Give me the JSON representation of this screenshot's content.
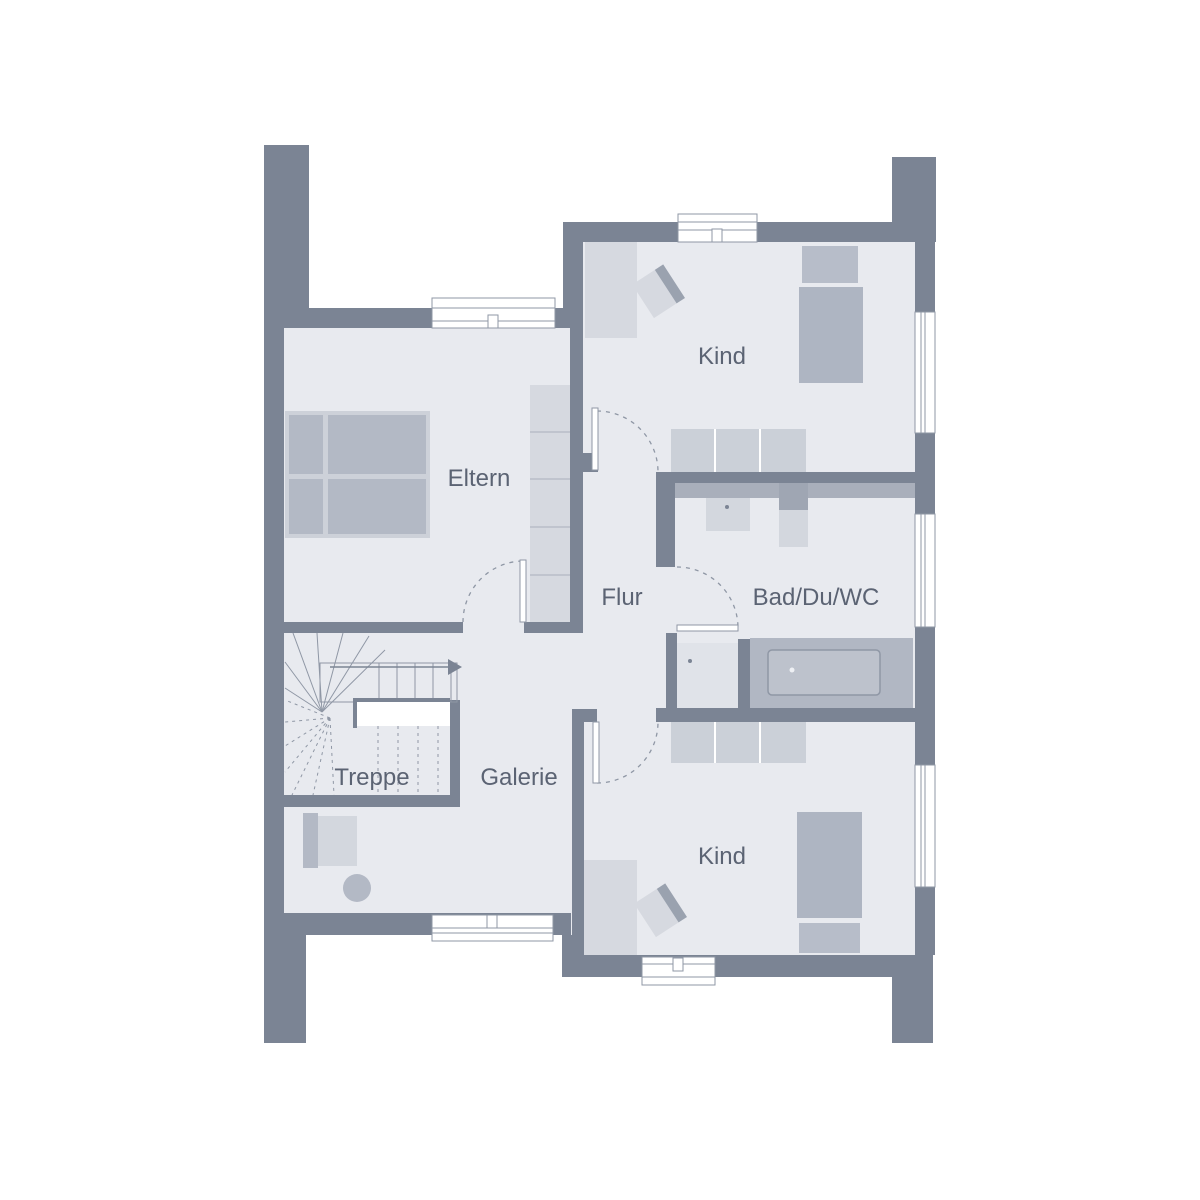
{
  "plan": {
    "type": "floor-plan",
    "floor_name": "Obergeschoss",
    "rooms": [
      {
        "id": "eltern",
        "label": "Eltern"
      },
      {
        "id": "kind-top",
        "label": "Kind"
      },
      {
        "id": "flur",
        "label": "Flur"
      },
      {
        "id": "bad",
        "label": "Bad/Du/WC"
      },
      {
        "id": "treppe",
        "label": "Treppe"
      },
      {
        "id": "galerie",
        "label": "Galerie"
      },
      {
        "id": "kind-bottom",
        "label": "Kind"
      }
    ],
    "colors": {
      "background": "#ffffff",
      "wall": "#7b8494",
      "floor": "#e8eaef",
      "outline": "#8f97a5",
      "furniture_light": "#d6d9e0",
      "furniture_frame": "#cdd1d9",
      "furniture_medium": "#b3b9c5",
      "bed": "#aeb5c2",
      "pillow": "#b7bdc9",
      "sideboard": "#cbd0d8",
      "closet": "#d6d9e0",
      "vanity": "#a9afbb",
      "cistern": "#9fa6b3",
      "fixture": "#d3d7de",
      "tub_platform": "#b1b7c3",
      "tub_inner": "#bdc2cc",
      "shower": "#e0e3e9",
      "desk_edge": "#9aa2af",
      "label_text": "#5b6373"
    }
  }
}
